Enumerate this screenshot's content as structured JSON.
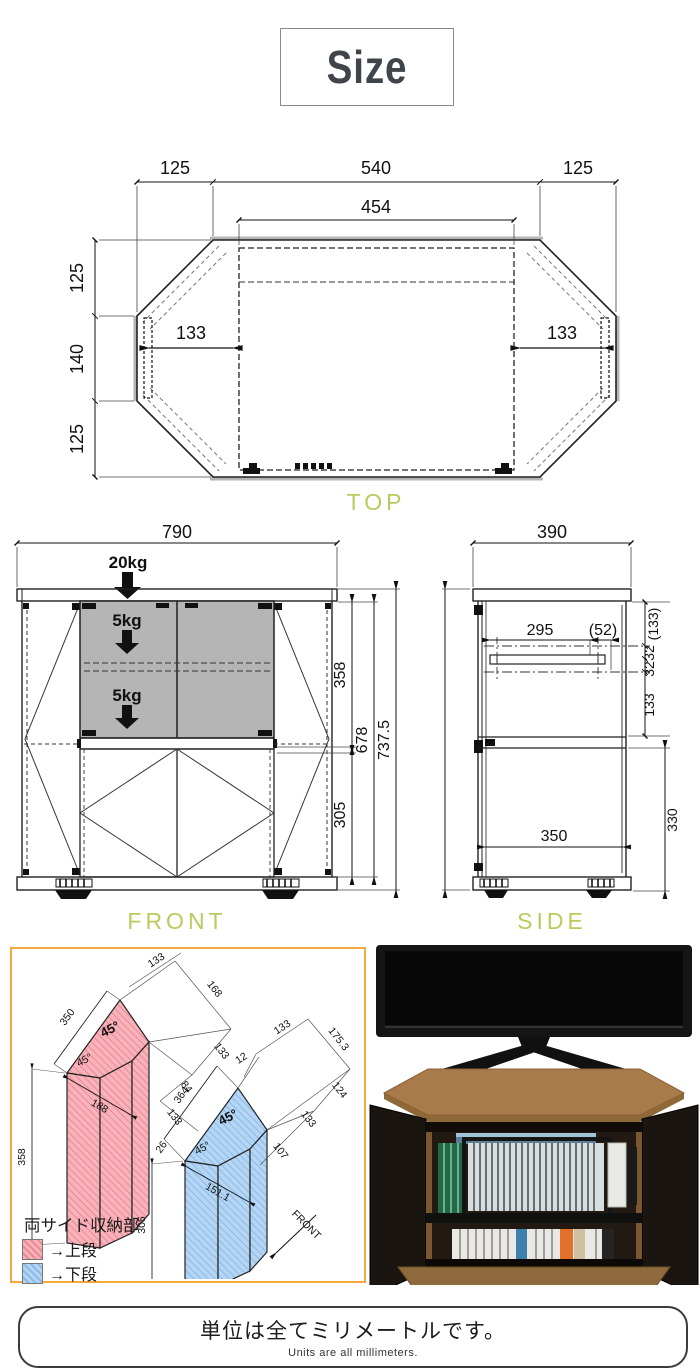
{
  "title": "Size",
  "palette": {
    "view_label_green": "#bcc95c",
    "iso_border_orange": "#f5a83e",
    "upper_red": "#f7b2ba",
    "lower_blue": "#b4d6f4",
    "shaded_gray": "#b5b5b5"
  },
  "top_view": {
    "label": "TOP",
    "w_left": "125",
    "w_center": "540",
    "w_right": "125",
    "w_inner": "454",
    "d_top": "125",
    "d_mid": "140",
    "d_bottom": "125",
    "pocket_left": "133",
    "pocket_right": "133"
  },
  "front_view": {
    "label": "FRONT",
    "width": "790",
    "load_top": "20kg",
    "load_upper": "5kg",
    "load_lower": "5kg",
    "h_upper": "358",
    "h_inner": "678",
    "h_total": "737.5",
    "h_lower": "305"
  },
  "side_view": {
    "label": "SIDE",
    "depth": "390",
    "rail": "295",
    "rail_gap": "(52)",
    "seg_top": "(133)",
    "seg_32a": "32",
    "seg_32b": "32",
    "seg_133": "133",
    "h_lower": "330",
    "d_inner": "350"
  },
  "iso": {
    "legend_title": "両サイド収納部",
    "legend_upper": "→上段",
    "legend_lower": "→下段",
    "upper": {
      "edge_len": "350",
      "height": "358",
      "base_diag": "188",
      "top_w": "133",
      "f1": "168",
      "f2": "133",
      "f3": "84",
      "f4": "133",
      "angle_top": "45°",
      "angle_left": "45°"
    },
    "lower": {
      "top_s": "12",
      "top_w": "133",
      "f1": "175.3",
      "f2": "124",
      "f3": "133",
      "f4": "107",
      "edge_len": "364",
      "edge_s": "26",
      "height": "305",
      "base_diag": "151.1",
      "angle_top": "45°",
      "angle_left": "45°",
      "front": "FRONT"
    }
  },
  "footer": {
    "jp": "単位は全てミリメートルです。",
    "en": "Units are all millimeters."
  }
}
